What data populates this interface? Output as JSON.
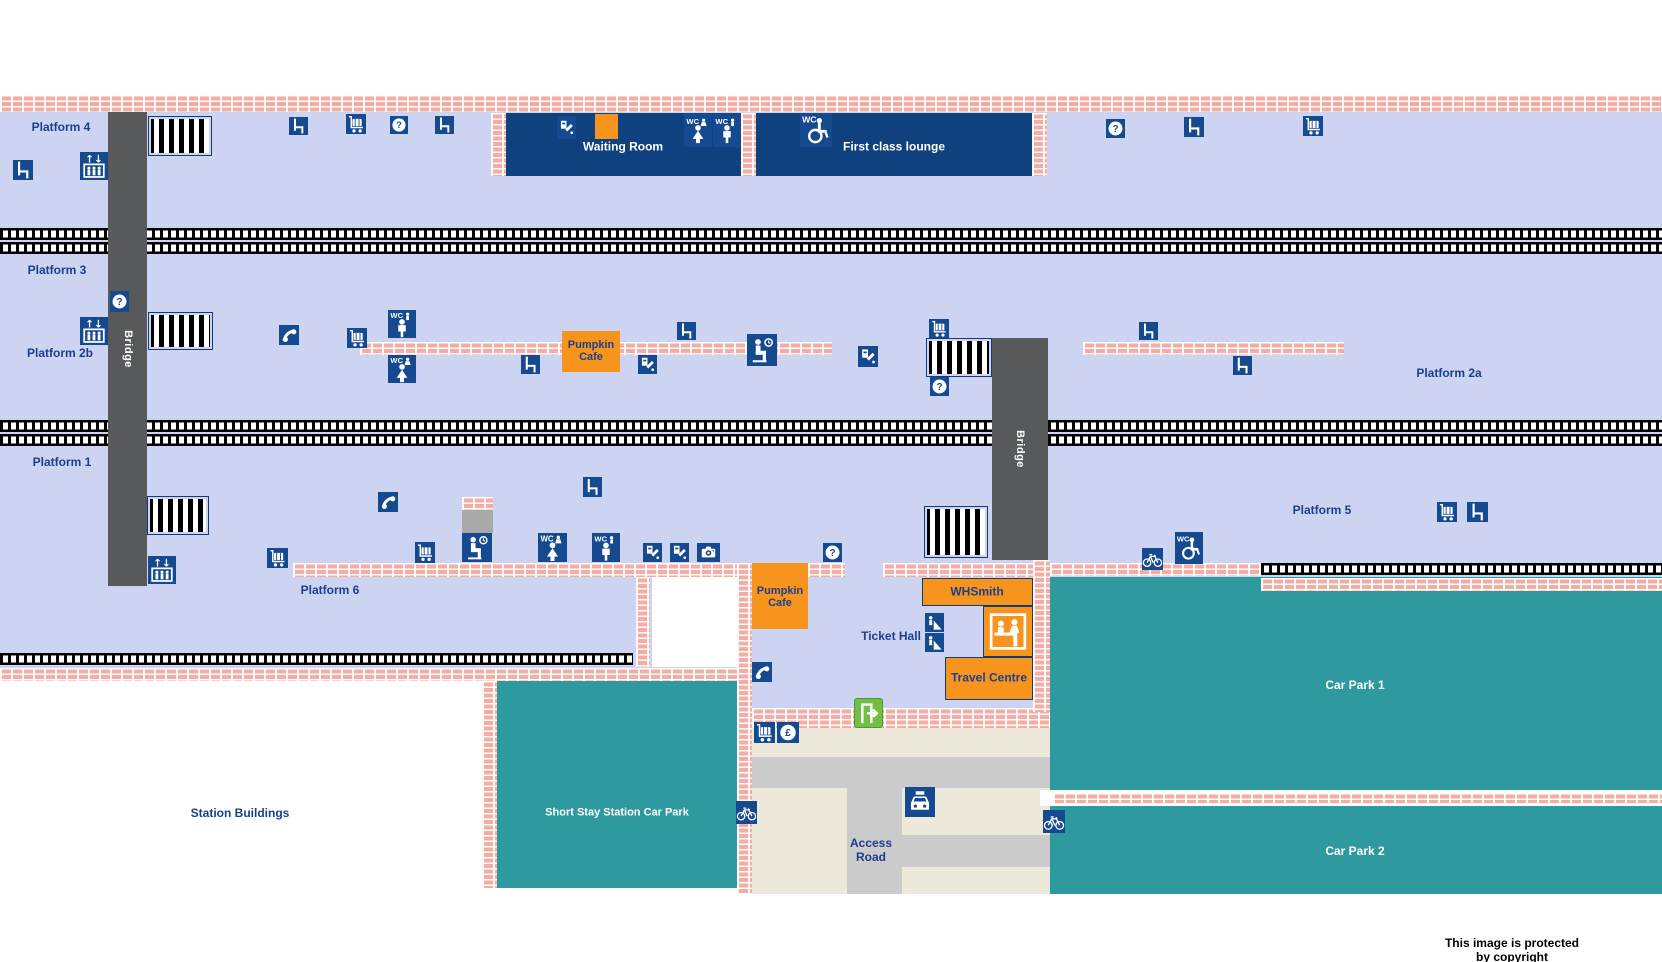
{
  "map": {
    "copyright": "This image is protected by copyright",
    "colors": {
      "light_blue": "#CCD4F1",
      "navy_box": "#10417F",
      "icon_bg": "#164A90",
      "label_navy": "#1B3F8C",
      "orange": "#F7941E",
      "teal": "#2E999E",
      "beige": "#ECE9DA",
      "road_gray": "#CBCBCB",
      "bridge_gray": "#58595B",
      "brick": "#F2ADA5",
      "exit_green": "#73BE44",
      "white": "#FFFFFF",
      "black": "#000000"
    },
    "zones": [
      {
        "name": "platform-area",
        "x": 0,
        "y": 95,
        "w": 1662,
        "h": 573,
        "fill": "#CCD4F1"
      },
      {
        "name": "concourse",
        "x": 752,
        "y": 668,
        "w": 283,
        "h": 60,
        "fill": "#CCD4F1"
      },
      {
        "name": "white-room",
        "x": 652,
        "y": 577,
        "w": 85,
        "h": 90,
        "fill": "#FFFFFF"
      },
      {
        "name": "short-stay-car-park",
        "x": 497,
        "y": 680,
        "w": 240,
        "h": 208,
        "fill": "#2E999E"
      },
      {
        "name": "forecourt",
        "x": 738,
        "y": 728,
        "w": 312,
        "h": 166,
        "fill": "#ECE9DA"
      },
      {
        "name": "car-park-1",
        "x": 1050,
        "y": 577,
        "w": 612,
        "h": 213,
        "fill": "#2E999E"
      },
      {
        "name": "car-park-divider",
        "x": 1040,
        "y": 790,
        "w": 622,
        "h": 16,
        "fill": "#FFFFFF"
      },
      {
        "name": "car-park-2",
        "x": 1050,
        "y": 806,
        "w": 612,
        "h": 88,
        "fill": "#2E999E"
      },
      {
        "name": "access-road-horizontal",
        "x": 752,
        "y": 757,
        "w": 298,
        "h": 31,
        "fill": "#CBCBCB"
      },
      {
        "name": "access-road-vertical",
        "x": 847,
        "y": 788,
        "w": 55,
        "h": 106,
        "fill": "#CBCBCB"
      },
      {
        "name": "access-road-spur",
        "x": 902,
        "y": 835,
        "w": 148,
        "h": 32,
        "fill": "#CBCBCB"
      },
      {
        "name": "shelter",
        "x": 462,
        "y": 510,
        "w": 31,
        "h": 23,
        "fill": "#A9A9A9"
      }
    ],
    "tracks": [
      [
        0,
        228,
        1662,
        12
      ],
      [
        0,
        242,
        1662,
        12
      ],
      [
        0,
        420,
        1662,
        12
      ],
      [
        0,
        434,
        1662,
        12
      ],
      [
        0,
        653,
        633,
        12
      ],
      [
        1261,
        563,
        401,
        12
      ]
    ],
    "bricks": [
      [
        0,
        95,
        1662,
        17
      ],
      [
        360,
        342,
        472,
        13
      ],
      [
        1083,
        342,
        261,
        13
      ],
      [
        293,
        563,
        460,
        14
      ],
      [
        808,
        563,
        37,
        14
      ],
      [
        883,
        563,
        167,
        14
      ],
      [
        636,
        577,
        14,
        90
      ],
      [
        737,
        563,
        15,
        331
      ],
      [
        482,
        670,
        15,
        218
      ],
      [
        0,
        668,
        737,
        13
      ],
      [
        752,
        708,
        298,
        20
      ],
      [
        1033,
        560,
        17,
        152
      ],
      [
        1050,
        563,
        211,
        13
      ],
      [
        1261,
        578,
        401,
        13
      ],
      [
        1053,
        793,
        609,
        10
      ],
      [
        491,
        113,
        15,
        63
      ],
      [
        741,
        113,
        15,
        63
      ],
      [
        1032,
        113,
        15,
        63
      ],
      [
        462,
        497,
        31,
        13
      ]
    ],
    "zebras": [
      [
        148,
        116,
        64,
        40
      ],
      [
        148,
        312,
        65,
        38
      ],
      [
        147,
        496,
        62,
        39
      ],
      [
        926,
        338,
        66,
        39
      ],
      [
        924,
        506,
        64,
        52
      ]
    ],
    "bridges": [
      {
        "x": 108,
        "y": 112,
        "w": 39,
        "h": 474,
        "label": "Bridge"
      },
      {
        "x": 992,
        "y": 338,
        "w": 56,
        "h": 222,
        "label": "Bridge"
      }
    ],
    "buildings": [
      {
        "name": "waiting-room",
        "x": 506,
        "y": 113,
        "w": 235,
        "h": 63,
        "fill": "#10417F",
        "label": "Waiting Room",
        "lc": "#FFFFFF",
        "ls": 12,
        "lx": 623,
        "ly": 147
      },
      {
        "name": "first-class-lounge",
        "x": 756,
        "y": 113,
        "w": 276,
        "h": 63,
        "fill": "#10417F",
        "label": "First class lounge",
        "lc": "#FFFFFF",
        "ls": 12,
        "lx": 894,
        "ly": 147
      },
      {
        "name": "pumpkin-cafe-platform",
        "x": 562,
        "y": 331,
        "w": 58,
        "h": 41,
        "fill": "#F7941E",
        "label": "Pumpkin\nCafe",
        "lc": "#1B3F8C",
        "ls": 11,
        "lx": 591,
        "ly": 351
      },
      {
        "name": "pumpkin-cafe-concourse",
        "x": 752,
        "y": 563,
        "w": 56,
        "h": 66,
        "fill": "#F7941E",
        "label": "Pumpkin\nCafe",
        "lc": "#1B3F8C",
        "ls": 11,
        "lx": 780,
        "ly": 597
      },
      {
        "name": "whsmith",
        "x": 922,
        "y": 578,
        "w": 111,
        "h": 28,
        "fill": "#F7941E",
        "border": "#123B72",
        "label": "WHSmith",
        "lc": "#1B3F8C",
        "ls": 12,
        "lx": 977,
        "ly": 592
      },
      {
        "name": "information-desk",
        "x": 983,
        "y": 606,
        "w": 50,
        "h": 51,
        "fill": "#F7941E",
        "border": "#123B72",
        "label": "",
        "lc": "#1B3F8C",
        "ls": 11,
        "lx": 1008,
        "ly": 631
      },
      {
        "name": "travel-centre",
        "x": 945,
        "y": 657,
        "w": 88,
        "h": 43,
        "fill": "#F7941E",
        "border": "#123B72",
        "label": "Travel Centre",
        "lc": "#1B3F8C",
        "ls": 12,
        "lx": 989,
        "ly": 678
      }
    ],
    "icons": [
      [
        "seat",
        13,
        160,
        20,
        20
      ],
      [
        "lift",
        80,
        152,
        28,
        28
      ],
      [
        "seat",
        289,
        117,
        19,
        18
      ],
      [
        "trolley",
        346,
        114,
        20,
        20
      ],
      [
        "help",
        390,
        116,
        18,
        18
      ],
      [
        "seat",
        435,
        116,
        19,
        18
      ],
      [
        "tvm",
        557,
        116,
        19,
        23
      ],
      [
        "cafe",
        595,
        114,
        23,
        25,
        "#F7941E"
      ],
      [
        "wc-f",
        684,
        113,
        28,
        34
      ],
      [
        "wc-m",
        713,
        113,
        28,
        34
      ],
      [
        "wc-acc",
        800,
        113,
        32,
        34
      ],
      [
        "help",
        1106,
        119,
        19,
        19
      ],
      [
        "seat",
        1184,
        117,
        20,
        20
      ],
      [
        "trolley",
        1303,
        116,
        20,
        20
      ],
      [
        "help",
        110,
        291,
        19,
        21
      ],
      [
        "lift",
        80,
        317,
        28,
        28
      ],
      [
        "phone",
        279,
        325,
        20,
        20
      ],
      [
        "trolley",
        347,
        328,
        20,
        20
      ],
      [
        "wc-m",
        388,
        310,
        28,
        28
      ],
      [
        "wc-f",
        388,
        355,
        28,
        28
      ],
      [
        "seat",
        521,
        355,
        19,
        19
      ],
      [
        "seat",
        677,
        322,
        19,
        18
      ],
      [
        "tvm",
        638,
        355,
        19,
        19
      ],
      [
        "waiting",
        747,
        334,
        30,
        32
      ],
      [
        "tvm",
        858,
        346,
        20,
        21
      ],
      [
        "trolley",
        929,
        319,
        20,
        19
      ],
      [
        "help",
        930,
        377,
        19,
        19
      ],
      [
        "seat",
        1139,
        322,
        19,
        18
      ],
      [
        "seat",
        1233,
        356,
        19,
        19
      ],
      [
        "phone",
        378,
        492,
        20,
        20
      ],
      [
        "seat",
        583,
        477,
        19,
        20
      ],
      [
        "lift",
        148,
        556,
        28,
        28
      ],
      [
        "trolley",
        267,
        548,
        21,
        20
      ],
      [
        "trolley",
        415,
        542,
        20,
        21
      ],
      [
        "waiting",
        462,
        533,
        30,
        29
      ],
      [
        "wc-f",
        538,
        533,
        29,
        29
      ],
      [
        "wc-m",
        592,
        533,
        28,
        29
      ],
      [
        "tvm",
        643,
        543,
        19,
        19
      ],
      [
        "tvm",
        670,
        543,
        19,
        19
      ],
      [
        "camera",
        697,
        543,
        23,
        19
      ],
      [
        "help",
        823,
        543,
        19,
        19
      ],
      [
        "bike",
        1142,
        548,
        21,
        22
      ],
      [
        "wc-acc",
        1175,
        532,
        28,
        32
      ],
      [
        "trolley",
        1437,
        502,
        20,
        20
      ],
      [
        "seat",
        1467,
        502,
        21,
        20
      ],
      [
        "phone",
        752,
        662,
        20,
        20
      ],
      [
        "twindow",
        925,
        613,
        19,
        19
      ],
      [
        "twindow",
        925,
        633,
        19,
        19
      ],
      [
        "infodesk",
        986,
        610,
        44,
        43,
        "none"
      ],
      [
        "exit",
        854,
        698,
        29,
        30,
        "#73BE44"
      ],
      [
        "trolley",
        754,
        722,
        21,
        21
      ],
      [
        "pound",
        777,
        722,
        22,
        21
      ],
      [
        "taxi",
        905,
        787,
        30,
        30
      ],
      [
        "bike",
        736,
        801,
        21,
        23
      ],
      [
        "bike",
        1043,
        810,
        22,
        23
      ]
    ],
    "labels": [
      {
        "t": "Platform 4",
        "x": 61,
        "y": 128,
        "c": "#1B3F8C",
        "s": 12
      },
      {
        "t": "Platform 3",
        "x": 57,
        "y": 271,
        "c": "#1B3F8C",
        "s": 12
      },
      {
        "t": "Platform 2b",
        "x": 60,
        "y": 354,
        "c": "#1B3F8C",
        "s": 12
      },
      {
        "t": "Platform 2a",
        "x": 1449,
        "y": 374,
        "c": "#1B3F8C",
        "s": 12
      },
      {
        "t": "Platform 1",
        "x": 62,
        "y": 463,
        "c": "#1B3F8C",
        "s": 12
      },
      {
        "t": "Platform 5",
        "x": 1322,
        "y": 511,
        "c": "#1B3F8C",
        "s": 12
      },
      {
        "t": "Platform 6",
        "x": 330,
        "y": 591,
        "c": "#1B3F8C",
        "s": 12
      },
      {
        "t": "Ticket Hall",
        "x": 891,
        "y": 637,
        "c": "#1B3F8C",
        "s": 12
      },
      {
        "t": "Station Buildings",
        "x": 240,
        "y": 814,
        "c": "#1B3F8C",
        "s": 12
      },
      {
        "t": "Access\nRoad",
        "x": 871,
        "y": 851,
        "c": "#1B3F8C",
        "s": 12
      },
      {
        "t": "Short Stay Station Car Park",
        "x": 617,
        "y": 813,
        "c": "#FFFFFF",
        "s": 11
      },
      {
        "t": "Car Park 1",
        "x": 1355,
        "y": 686,
        "c": "#FFFFFF",
        "s": 12
      },
      {
        "t": "Car Park 2",
        "x": 1355,
        "y": 852,
        "c": "#FFFFFF",
        "s": 12
      },
      {
        "t": "This image is protected by copyright",
        "x": 1512,
        "y": 951,
        "c": "#000000",
        "s": 12
      }
    ]
  }
}
